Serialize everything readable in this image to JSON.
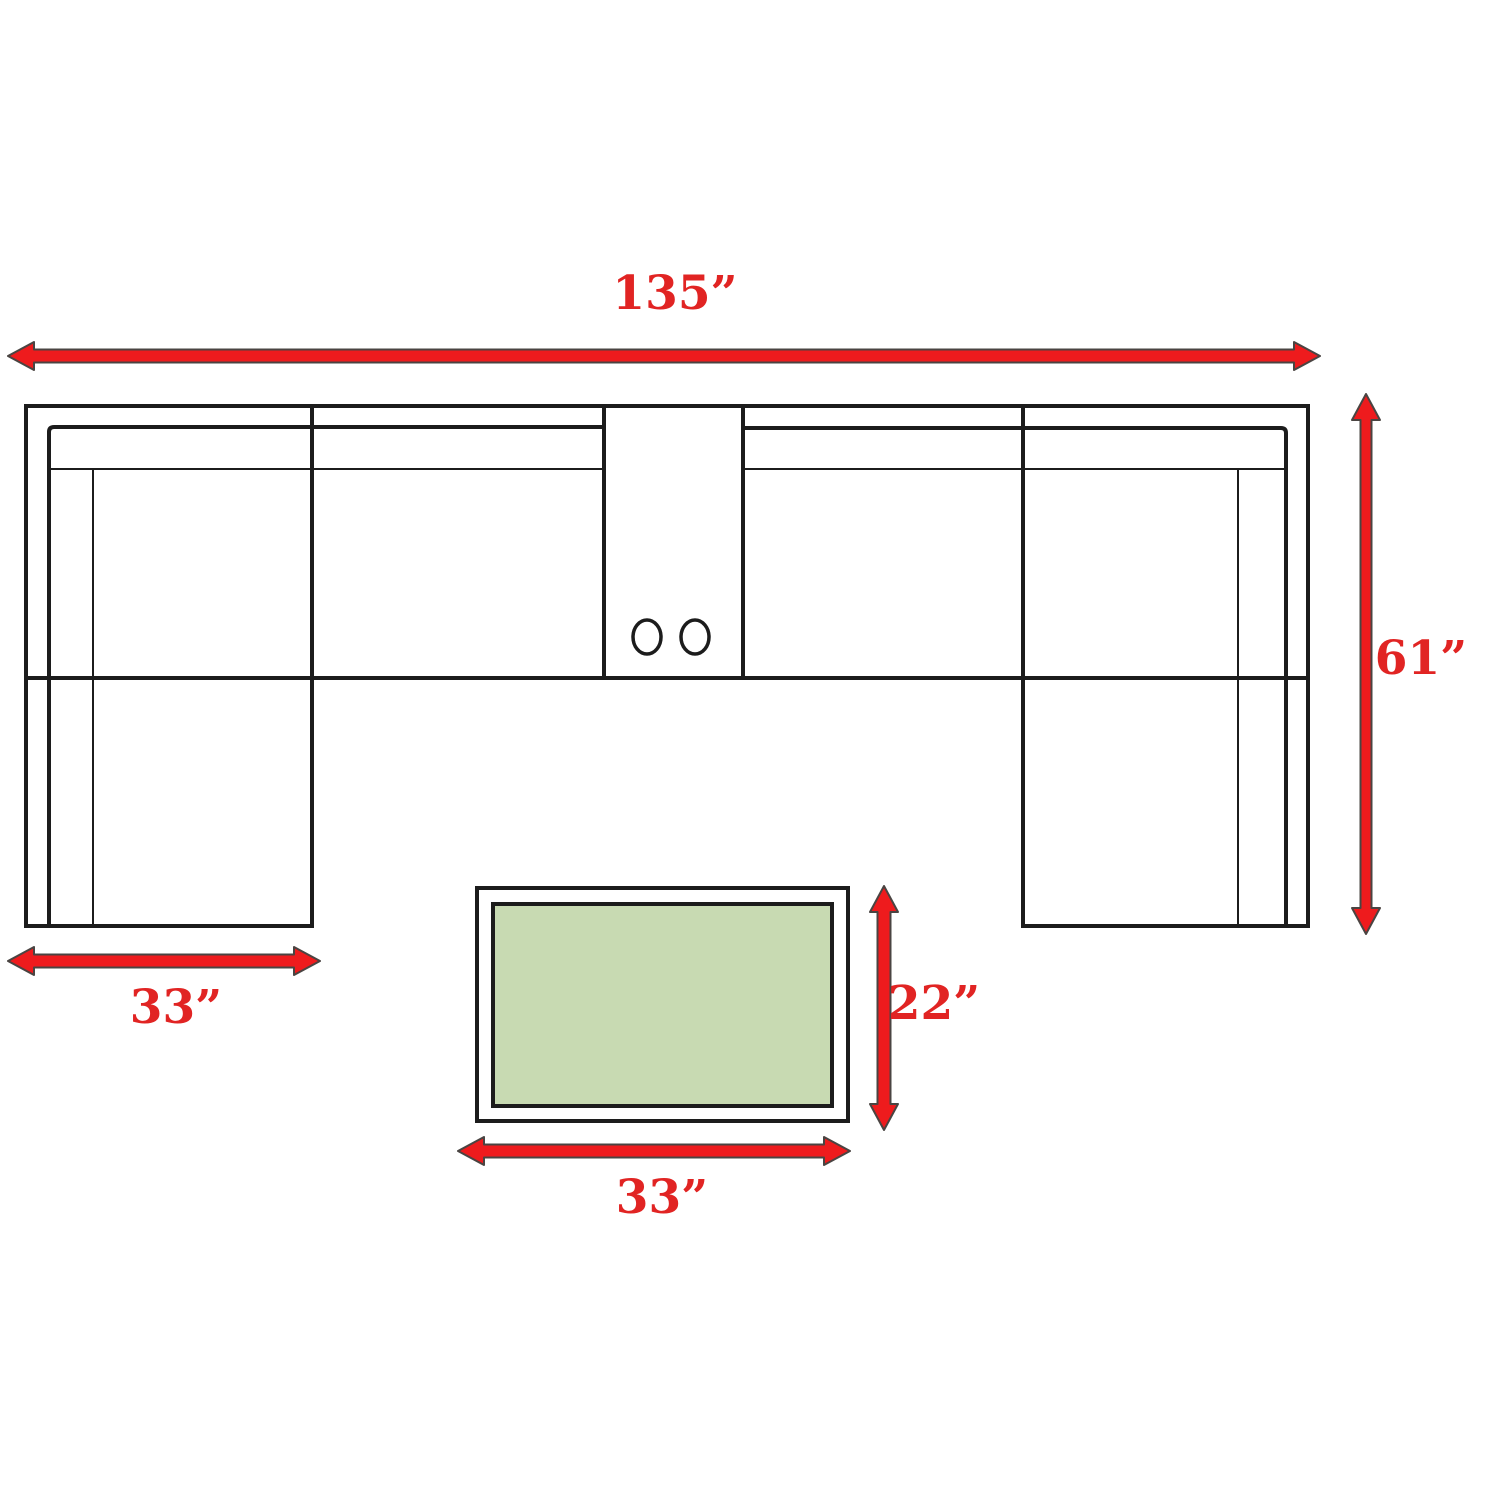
{
  "diagram": {
    "dimensions": {
      "overall_width": "135”",
      "overall_depth": "61”",
      "chaise_width": "33”",
      "table_depth": "22”",
      "table_width": "33”"
    },
    "colors": {
      "arrow_fill": "#ee1b1d",
      "arrow_outline": "#4a4442",
      "label_red": "#e12423",
      "line_black": "#1c1c1c",
      "table_green": "#c8dab2",
      "background": "#ffffff"
    }
  }
}
